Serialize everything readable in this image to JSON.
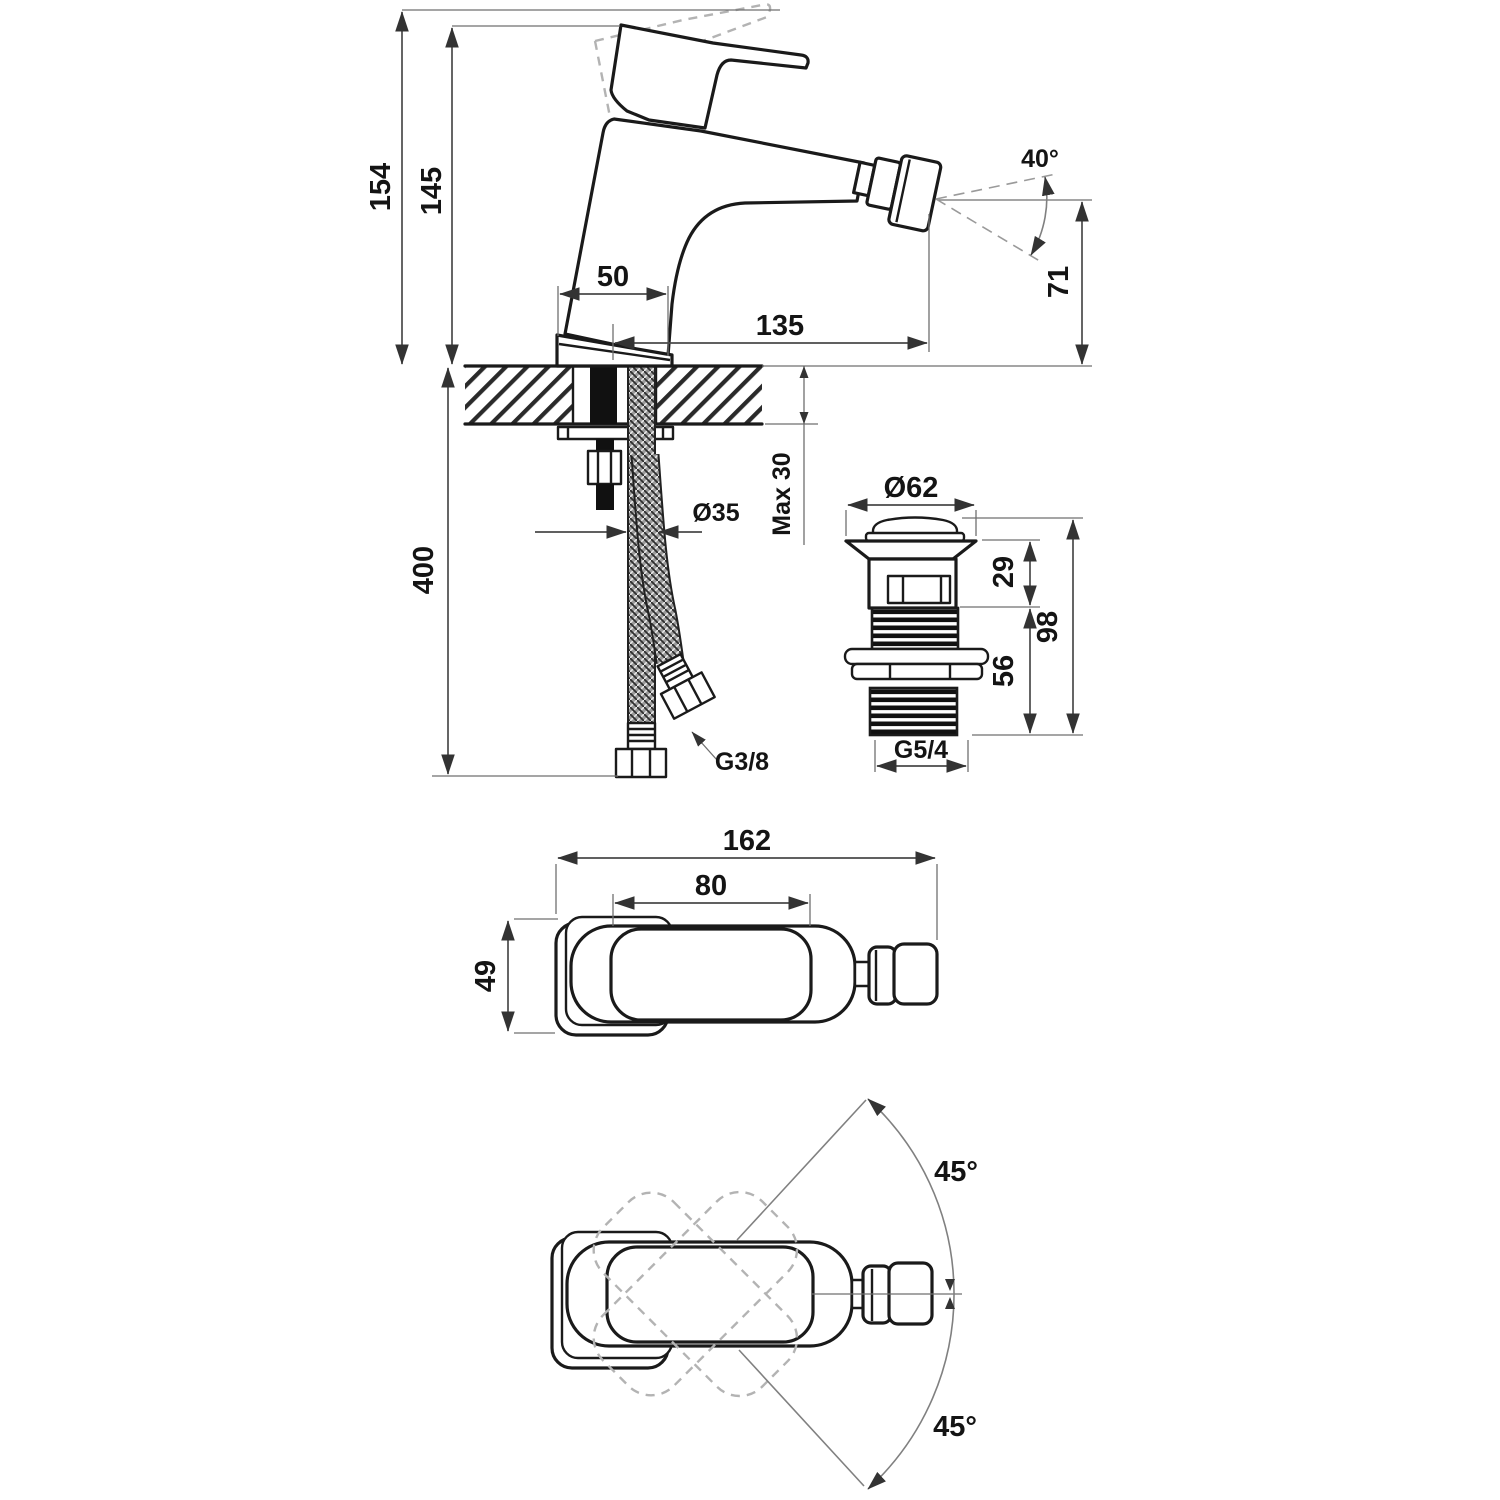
{
  "drawing": {
    "kind": "technical-dimension-drawing",
    "subject": "single-lever bidet mixer faucet with pop-up waste",
    "background": "#ffffff",
    "line_color": "#1a1a1a",
    "dimension_color": "#4a4a4a",
    "dashed_color": "#b3b3b3"
  },
  "side_view": {
    "labels": {
      "height_total": "154",
      "height_to_handle": "145",
      "base_width": "50",
      "spout_reach": "135",
      "spray_angle": "40°",
      "outlet_height": "71",
      "deck_thickness": "Max 30",
      "hole_diameter": "Ø35",
      "hose_length": "400",
      "hose_thread": "G3/8"
    }
  },
  "drain_view": {
    "labels": {
      "cap_diameter": "Ø62",
      "upper_height": "29",
      "total_height": "98",
      "lower_height": "56",
      "thread": "G5/4"
    }
  },
  "top_view": {
    "labels": {
      "total_length": "162",
      "handle_length": "80",
      "body_width": "49"
    }
  },
  "swivel_view": {
    "labels": {
      "angle_upper": "45°",
      "angle_lower": "45°"
    }
  }
}
